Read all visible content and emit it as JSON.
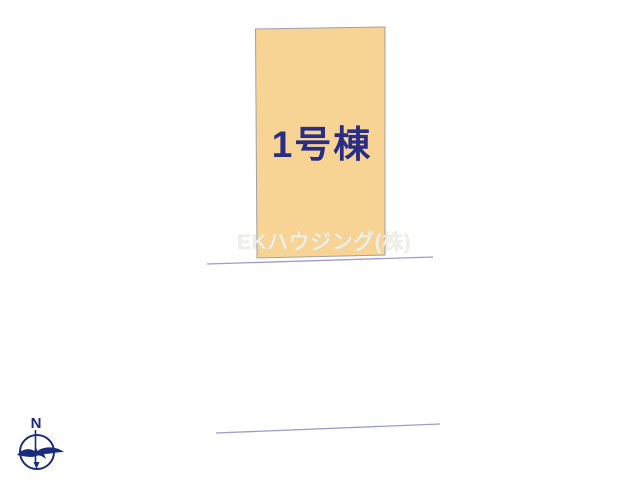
{
  "site_plan": {
    "lot": {
      "label": "1号棟"
    },
    "watermark": "EKハウジング(株)",
    "compass": {
      "north_label": "N"
    },
    "colors": {
      "lot_fill": "#F7D494",
      "lot_border": "#A0A0AC",
      "label_text": "#2A2D86",
      "road_line": "#9C9CCE",
      "compass": "#1A2C7E",
      "watermark_text": "#EFEFE8"
    }
  }
}
